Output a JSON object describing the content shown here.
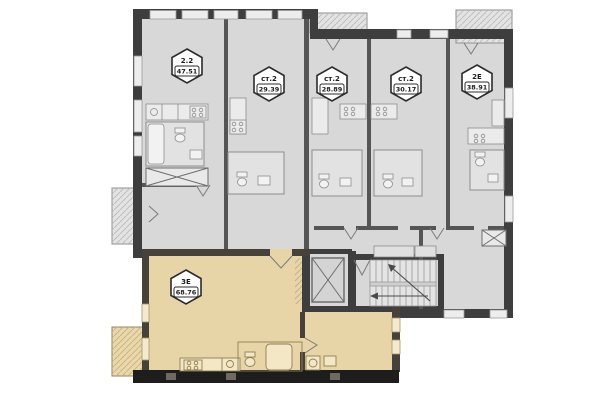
{
  "plan": {
    "units": [
      {
        "id": "2-2",
        "type": "2.2",
        "area": "47.51"
      },
      {
        "id": "st2-a",
        "type": "ст.2",
        "area": "29.39"
      },
      {
        "id": "st2-b",
        "type": "ст.2",
        "area": "28.89"
      },
      {
        "id": "st2-c",
        "type": "ст.2",
        "area": "30.17"
      },
      {
        "id": "2e",
        "type": "2Е",
        "area": "38.91"
      },
      {
        "id": "3e",
        "type": "3Е",
        "area": "68.76"
      }
    ],
    "colors": {
      "room_fill": "#d8d8d8",
      "highlight_fill": "#e8d5a7",
      "wall": "#3e3e3e",
      "wall_black": "#1d1d1d",
      "badge_bg": "#ffffff",
      "badge_border": "#2b2b2b"
    }
  }
}
